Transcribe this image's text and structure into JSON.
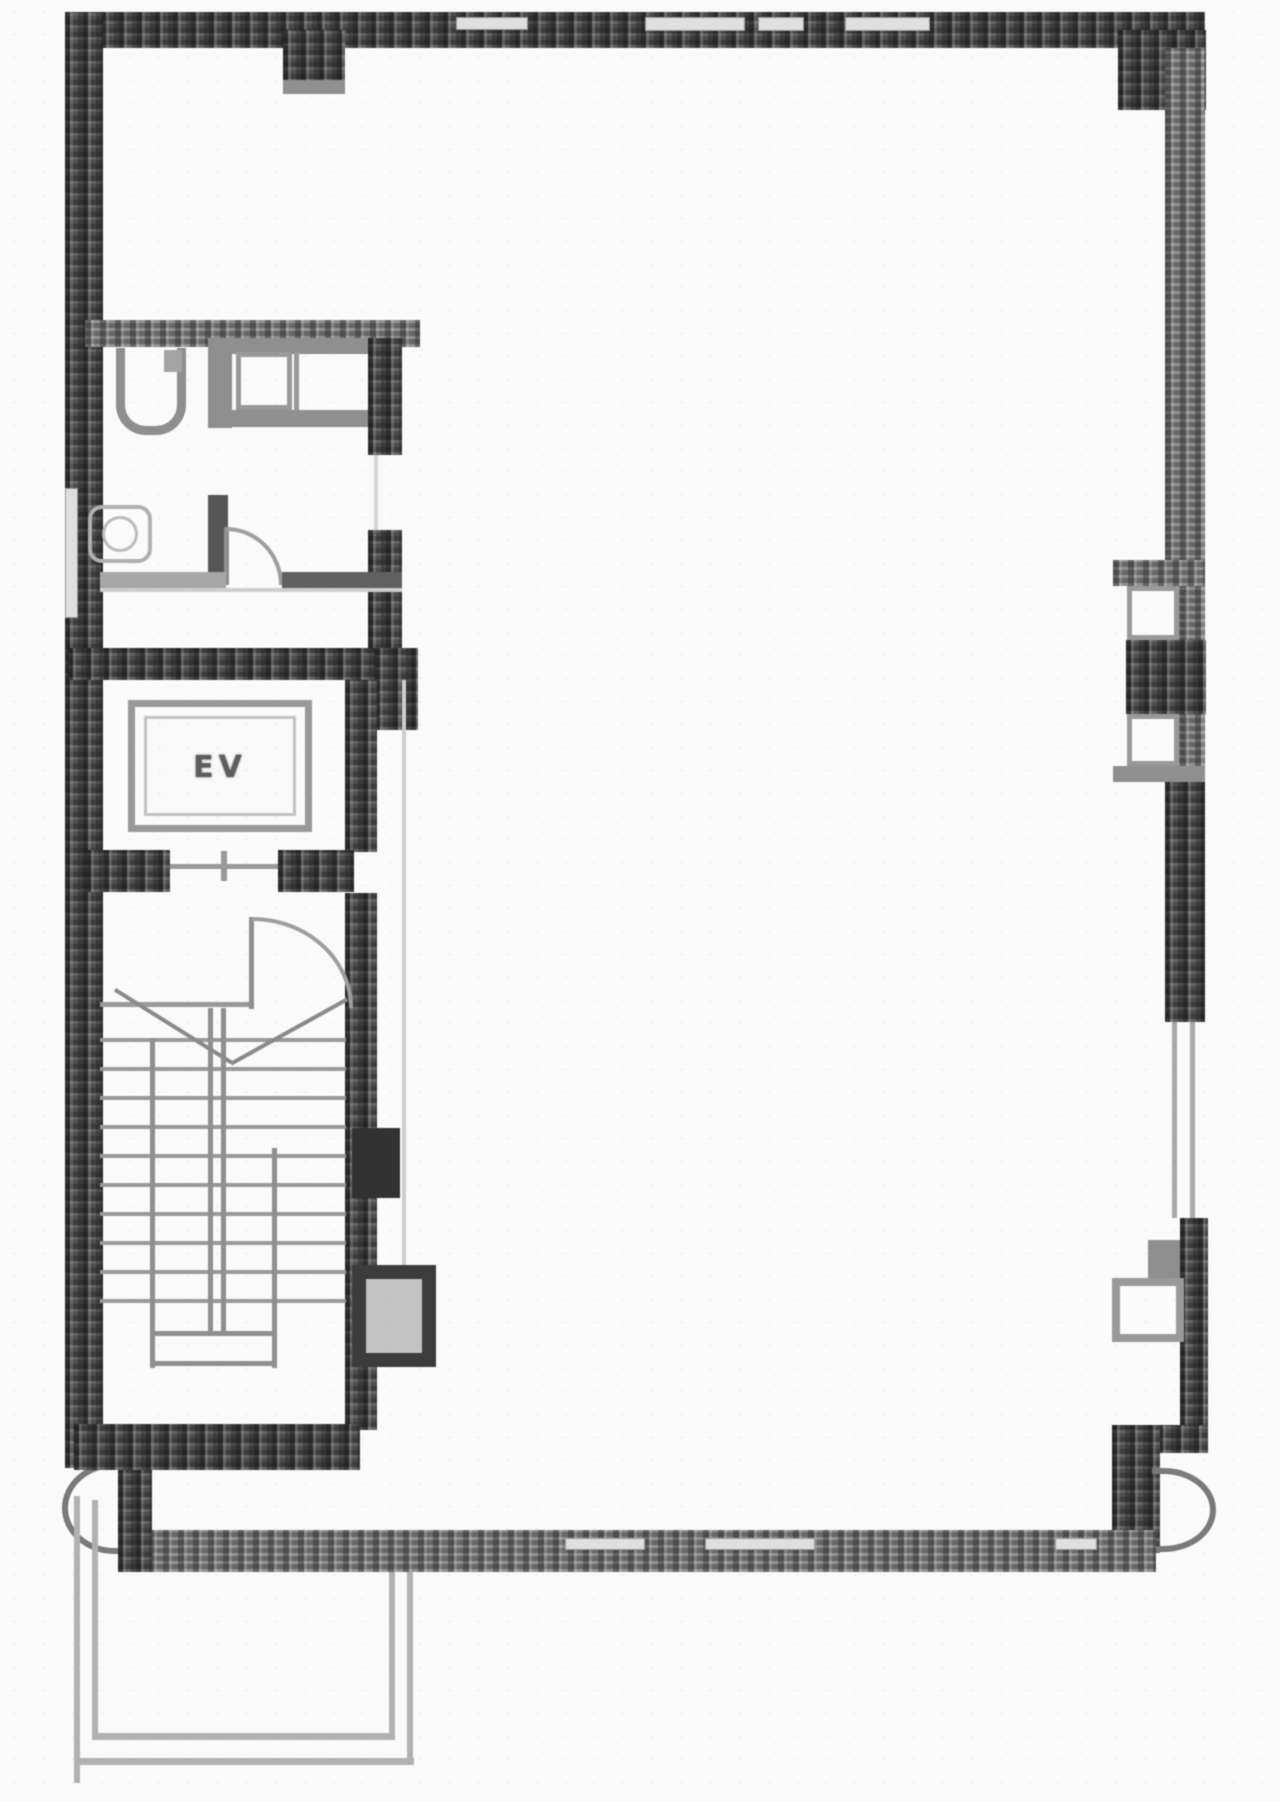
{
  "plan": {
    "elevator_label": "EV"
  },
  "fixtures": {
    "elevator": "elevator-car",
    "stairs": "staircase-treads",
    "urinal": "urinal-fixture",
    "toilet": "toilet-fixture",
    "sink": "sink-counter",
    "doors": "door-swing-arc",
    "windows": "window-slit",
    "entrance": "entrance-porch"
  },
  "colors": {
    "background": "#ffffff",
    "wall_dark": "#4b4b4b",
    "wall_medium": "#7e7e7e",
    "partition": "#8f8f8f",
    "fixture_line": "#b2b2b2",
    "thin_line": "#b3b3b3",
    "label_text": "#5c5c5c"
  }
}
